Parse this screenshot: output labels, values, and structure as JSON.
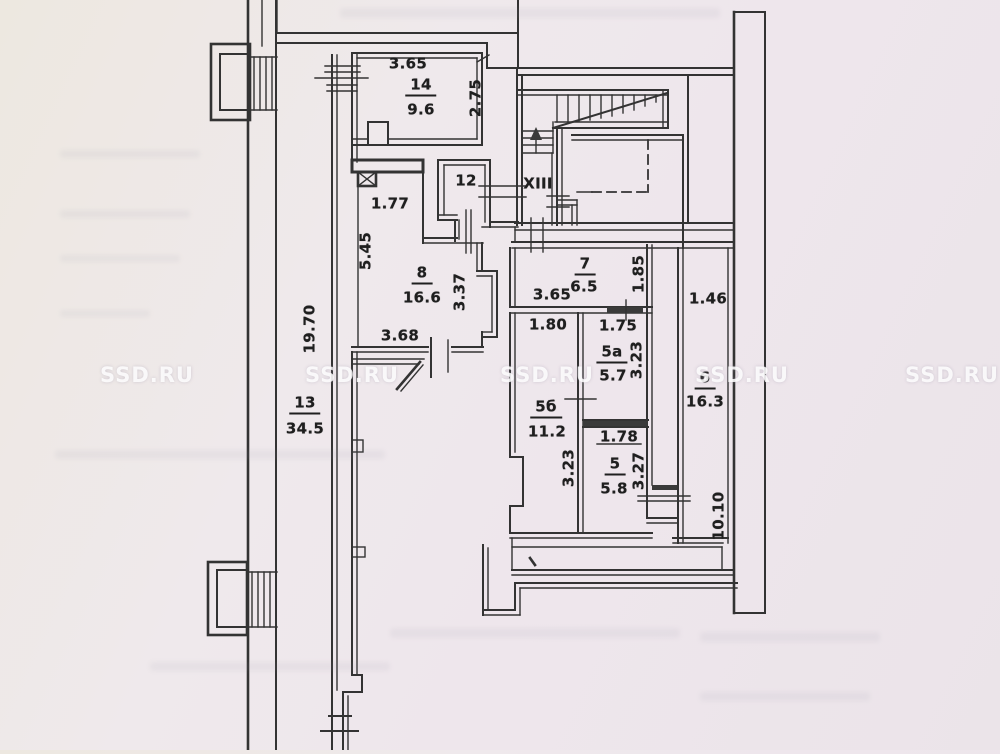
{
  "plan": {
    "colors": {
      "paper": "#ede8e8",
      "line": "#333333",
      "label": "#1f1f1f"
    },
    "watermark": {
      "text": "SSD.RU",
      "y": 375,
      "xs": [
        147,
        352,
        547,
        742,
        952
      ]
    },
    "labels": [
      {
        "name": "dim-3-65-room14",
        "text": "3.65",
        "x": 408,
        "y": 64,
        "rot": false,
        "underline": false
      },
      {
        "name": "room-14-number",
        "text": "14",
        "x": 421,
        "y": 87,
        "rot": false,
        "underline": true
      },
      {
        "name": "room-14-area",
        "text": "9.6",
        "x": 421,
        "y": 110,
        "rot": false,
        "underline": false
      },
      {
        "name": "dim-2-75",
        "text": "2.75",
        "x": 476,
        "y": 98,
        "rot": true,
        "underline": false
      },
      {
        "name": "dim-1-77",
        "text": "1.77",
        "x": 390,
        "y": 204,
        "rot": false,
        "underline": false
      },
      {
        "name": "room-12-number",
        "text": "12",
        "x": 466,
        "y": 181,
        "rot": false,
        "underline": false
      },
      {
        "name": "stair-hall-XIII",
        "text": "XIII",
        "x": 538,
        "y": 184,
        "rot": false,
        "underline": false
      },
      {
        "name": "dim-5-45",
        "text": "5.45",
        "x": 366,
        "y": 251,
        "rot": true,
        "underline": false
      },
      {
        "name": "room-8-number",
        "text": "8",
        "x": 422,
        "y": 275,
        "rot": false,
        "underline": true
      },
      {
        "name": "room-8-area",
        "text": "16.6",
        "x": 422,
        "y": 298,
        "rot": false,
        "underline": false
      },
      {
        "name": "dim-3-37",
        "text": "3.37",
        "x": 460,
        "y": 292,
        "rot": true,
        "underline": false
      },
      {
        "name": "dim-3-68",
        "text": "3.68",
        "x": 400,
        "y": 336,
        "rot": false,
        "underline": false
      },
      {
        "name": "room-7-number",
        "text": "7",
        "x": 585,
        "y": 266,
        "rot": false,
        "underline": true
      },
      {
        "name": "room-7-area",
        "text": "6.5",
        "x": 584,
        "y": 287,
        "rot": false,
        "underline": false
      },
      {
        "name": "dim-3-65-room7",
        "text": "3.65",
        "x": 552,
        "y": 295,
        "rot": false,
        "underline": false
      },
      {
        "name": "dim-1-85",
        "text": "1.85",
        "x": 639,
        "y": 274,
        "rot": true,
        "underline": false
      },
      {
        "name": "dim-1-80",
        "text": "1.80",
        "x": 548,
        "y": 325,
        "rot": false,
        "underline": false
      },
      {
        "name": "dim-1-75",
        "text": "1.75",
        "x": 618,
        "y": 326,
        "rot": false,
        "underline": false
      },
      {
        "name": "room-5a-number",
        "text": "5а",
        "x": 612,
        "y": 354,
        "rot": false,
        "underline": true
      },
      {
        "name": "room-5a-area",
        "text": "5.7",
        "x": 613,
        "y": 376,
        "rot": false,
        "underline": false
      },
      {
        "name": "dim-3-23-5a",
        "text": "3.23",
        "x": 637,
        "y": 360,
        "rot": true,
        "underline": false
      },
      {
        "name": "dim-1-46",
        "text": "1.46",
        "x": 708,
        "y": 299,
        "rot": false,
        "underline": false
      },
      {
        "name": "room-6-number",
        "text": "6",
        "x": 705,
        "y": 380,
        "rot": false,
        "underline": true
      },
      {
        "name": "room-6-area",
        "text": "16.3",
        "x": 705,
        "y": 402,
        "rot": false,
        "underline": false
      },
      {
        "name": "room-5b-number",
        "text": "5б",
        "x": 546,
        "y": 409,
        "rot": false,
        "underline": true
      },
      {
        "name": "room-5b-area",
        "text": "11.2",
        "x": 547,
        "y": 432,
        "rot": false,
        "underline": false
      },
      {
        "name": "dim-1-78",
        "text": "1.78",
        "x": 619,
        "y": 437,
        "rot": false,
        "underline": false
      },
      {
        "name": "dim-3-23-5b",
        "text": "3.23",
        "x": 569,
        "y": 468,
        "rot": true,
        "underline": false
      },
      {
        "name": "room-5-number",
        "text": "5",
        "x": 615,
        "y": 466,
        "rot": false,
        "underline": true
      },
      {
        "name": "room-5-area",
        "text": "5.8",
        "x": 614,
        "y": 489,
        "rot": false,
        "underline": false
      },
      {
        "name": "dim-3-27",
        "text": "3.27",
        "x": 639,
        "y": 471,
        "rot": true,
        "underline": false
      },
      {
        "name": "dim-10-10",
        "text": "10.10",
        "x": 719,
        "y": 516,
        "rot": true,
        "underline": false
      },
      {
        "name": "room-13-number",
        "text": "13",
        "x": 305,
        "y": 405,
        "rot": false,
        "underline": true
      },
      {
        "name": "room-13-area",
        "text": "34.5",
        "x": 305,
        "y": 429,
        "rot": false,
        "underline": false
      },
      {
        "name": "dim-19-70",
        "text": "19.70",
        "x": 310,
        "y": 329,
        "rot": true,
        "underline": false
      }
    ]
  }
}
